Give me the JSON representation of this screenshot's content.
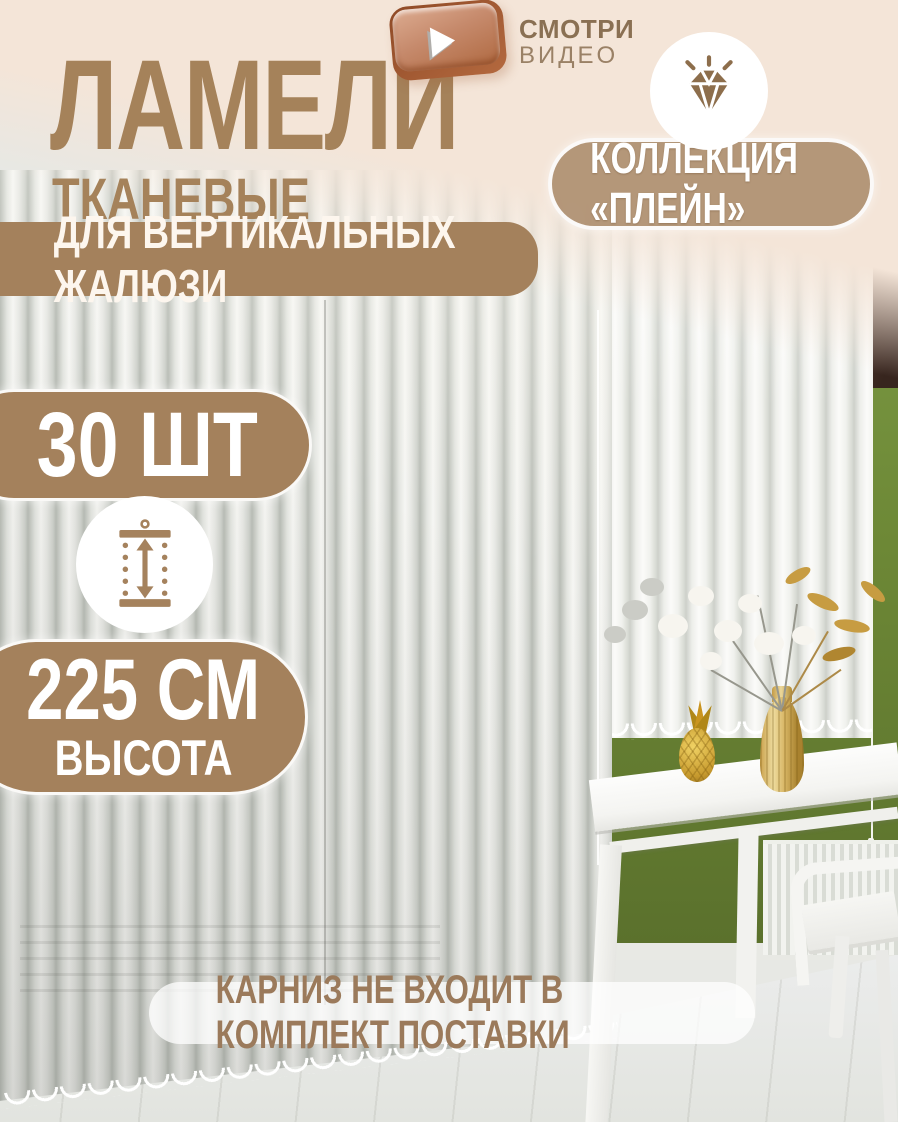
{
  "header": {
    "title": "ЛАМЕЛИ",
    "subtitle": "ТКАНЕВЫЕ",
    "banner": "ДЛЯ ВЕРТИКАЛЬНЫХ ЖАЛЮЗИ"
  },
  "video_cta": {
    "line1": "СМОТРИ",
    "line2": "ВИДЕО",
    "icon": "play-icon"
  },
  "collection": {
    "label": "КОЛЛЕКЦИЯ «ПЛЕЙН»",
    "icon": "diamond-icon"
  },
  "quantity": {
    "label": "30 ШТ"
  },
  "height": {
    "value": "225 СМ",
    "label": "ВЫСОТА",
    "icon": "height-measure-icon"
  },
  "footer": {
    "note": "КАРНИЗ НЕ ВХОДИТ В КОМПЛЕКТ ПОСТАВКИ"
  },
  "colors": {
    "cream_background": "#f4e5d8",
    "badge_brown": "#a4815c",
    "title_brown": "#a5825a",
    "video_text_brown": "#8a7053",
    "copper_play_button": "#b4693f",
    "white": "#ffffff",
    "green_wall": "#6d8836",
    "note_text_brown": "#9b7a5b"
  }
}
